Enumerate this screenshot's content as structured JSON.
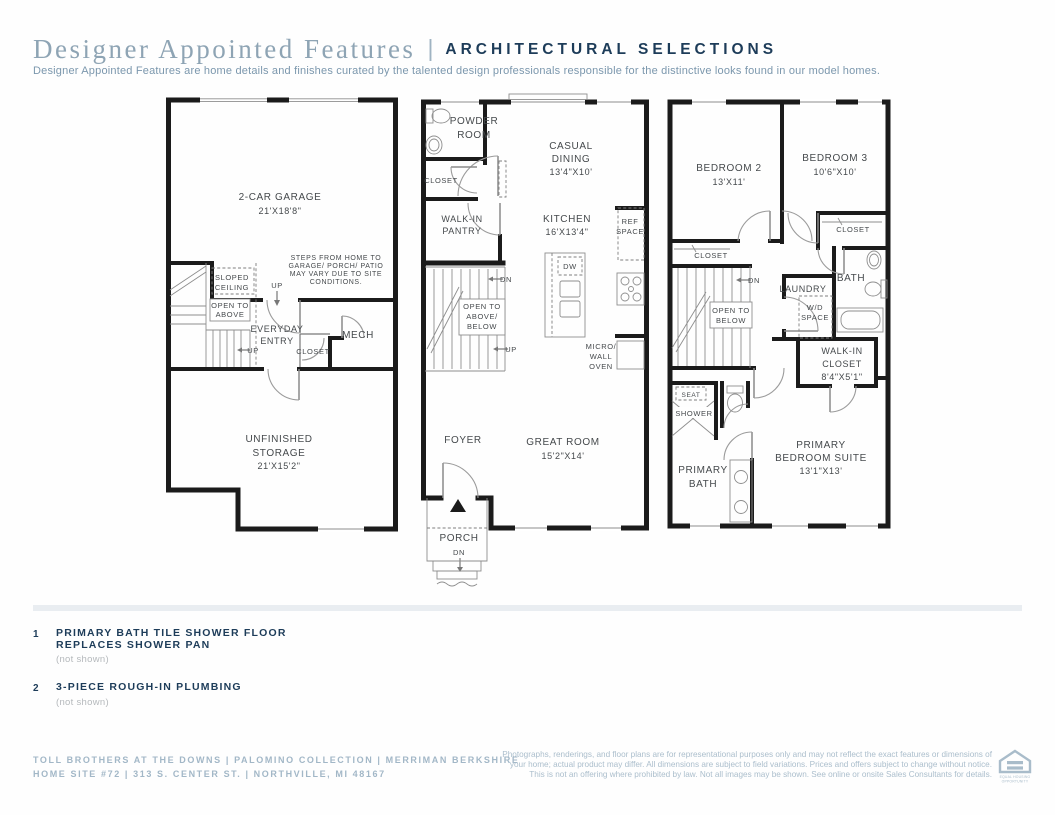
{
  "header": {
    "title": "Designer Appointed Features",
    "separator": "|",
    "subtitle_label": "ARCHITECTURAL SELECTIONS",
    "description": "Designer Appointed Features are home details and finishes curated by the talented design professionals responsible for the distinctive looks found in our model homes."
  },
  "plans": {
    "lower": {
      "garage_1": "2-CAR GARAGE",
      "garage_2": "21'X18'8\"",
      "note_1": "STEPS FROM HOME TO",
      "note_2": "GARAGE/ PORCH/ PATIO",
      "note_3": "MAY VARY DUE TO SITE",
      "note_4": "CONDITIONS.",
      "sloped_1": "SLOPED",
      "sloped_2": "CEILING",
      "up_top": "UP",
      "open_1": "OPEN TO",
      "open_2": "ABOVE",
      "up_stair": "UP",
      "entry_1": "EVERYDAY",
      "entry_2": "ENTRY",
      "closet": "CLOSET",
      "mech": "MECH",
      "storage_1": "UNFINISHED",
      "storage_2": "STORAGE",
      "storage_3": "21'X15'2\""
    },
    "main": {
      "powder_1": "POWDER",
      "powder_2": "ROOM",
      "closet": "CLOSET",
      "pantry_1": "WALK-IN",
      "pantry_2": "PANTRY",
      "dining_1": "CASUAL",
      "dining_2": "DINING",
      "dining_3": "13'4\"X10'",
      "kitchen_1": "KITCHEN",
      "kitchen_2": "16'X13'4\"",
      "ref_1": "REF",
      "ref_2": "SPACE",
      "dw": "DW",
      "dn": "DN",
      "up": "UP",
      "open_1": "OPEN TO",
      "open_2": "ABOVE/",
      "open_3": "BELOW",
      "micro_1": "MICRO/",
      "micro_2": "WALL",
      "micro_3": "OVEN",
      "foyer": "FOYER",
      "great_1": "GREAT ROOM",
      "great_2": "15'2\"X14'",
      "porch": "PORCH",
      "porch_dn": "DN"
    },
    "upper": {
      "bed2_1": "BEDROOM 2",
      "bed2_2": "13'X11'",
      "bed3_1": "BEDROOM 3",
      "bed3_2": "10'6\"X10'",
      "closet_right": "CLOSET",
      "closet_left": "CLOSET",
      "dn": "DN",
      "open_1": "OPEN TO",
      "open_2": "BELOW",
      "laundry": "LAUNDRY",
      "wd_1": "W/D",
      "wd_2": "SPACE",
      "bath": "BATH",
      "wic_1": "WALK-IN",
      "wic_2": "CLOSET",
      "wic_3": "8'4\"X5'1\"",
      "seat": "SEAT",
      "shower": "SHOWER",
      "pbath_1": "PRIMARY",
      "pbath_2": "BATH",
      "suite_1": "PRIMARY",
      "suite_2": "BEDROOM SUITE",
      "suite_3": "13'1\"X13'"
    }
  },
  "features": [
    {
      "num": "1",
      "line1": "PRIMARY BATH TILE SHOWER FLOOR",
      "line2": "REPLACES SHOWER PAN",
      "note": "(not shown)"
    },
    {
      "num": "2",
      "line1": "3-PIECE ROUGH-IN PLUMBING",
      "note": "(not shown)"
    }
  ],
  "footer": {
    "left_line1": "TOLL BROTHERS AT THE DOWNS | PALOMINO COLLECTION | MERRIMAN BERKSHIRE",
    "left_line2": "HOME SITE #72 | 313 S. CENTER ST. | NORTHVILLE, MI 48167",
    "disclaimer_1": "Photographs, renderings, and floor plans are for representational purposes only and may not reflect the exact features or dimensions of",
    "disclaimer_2": "your home; actual product may differ. All dimensions are subject to field variations. Prices and offers subject to change without notice.",
    "disclaimer_3": "This is not an offering where prohibited by law. Not all images may be shown. See online or onsite Sales Consultants for details.",
    "equal_housing_1": "EQUAL HOUSING",
    "equal_housing_2": "OPPORTUNITY"
  },
  "colors": {
    "title_serif": "#8ea4b4",
    "navy": "#1d3c59",
    "subtitle_blue": "#7b97ad",
    "footer_blue": "#a2b7c7",
    "wall_black": "#1b1b1b",
    "divider_gray": "#e9edf1",
    "note_gray": "#b5b9bc"
  }
}
